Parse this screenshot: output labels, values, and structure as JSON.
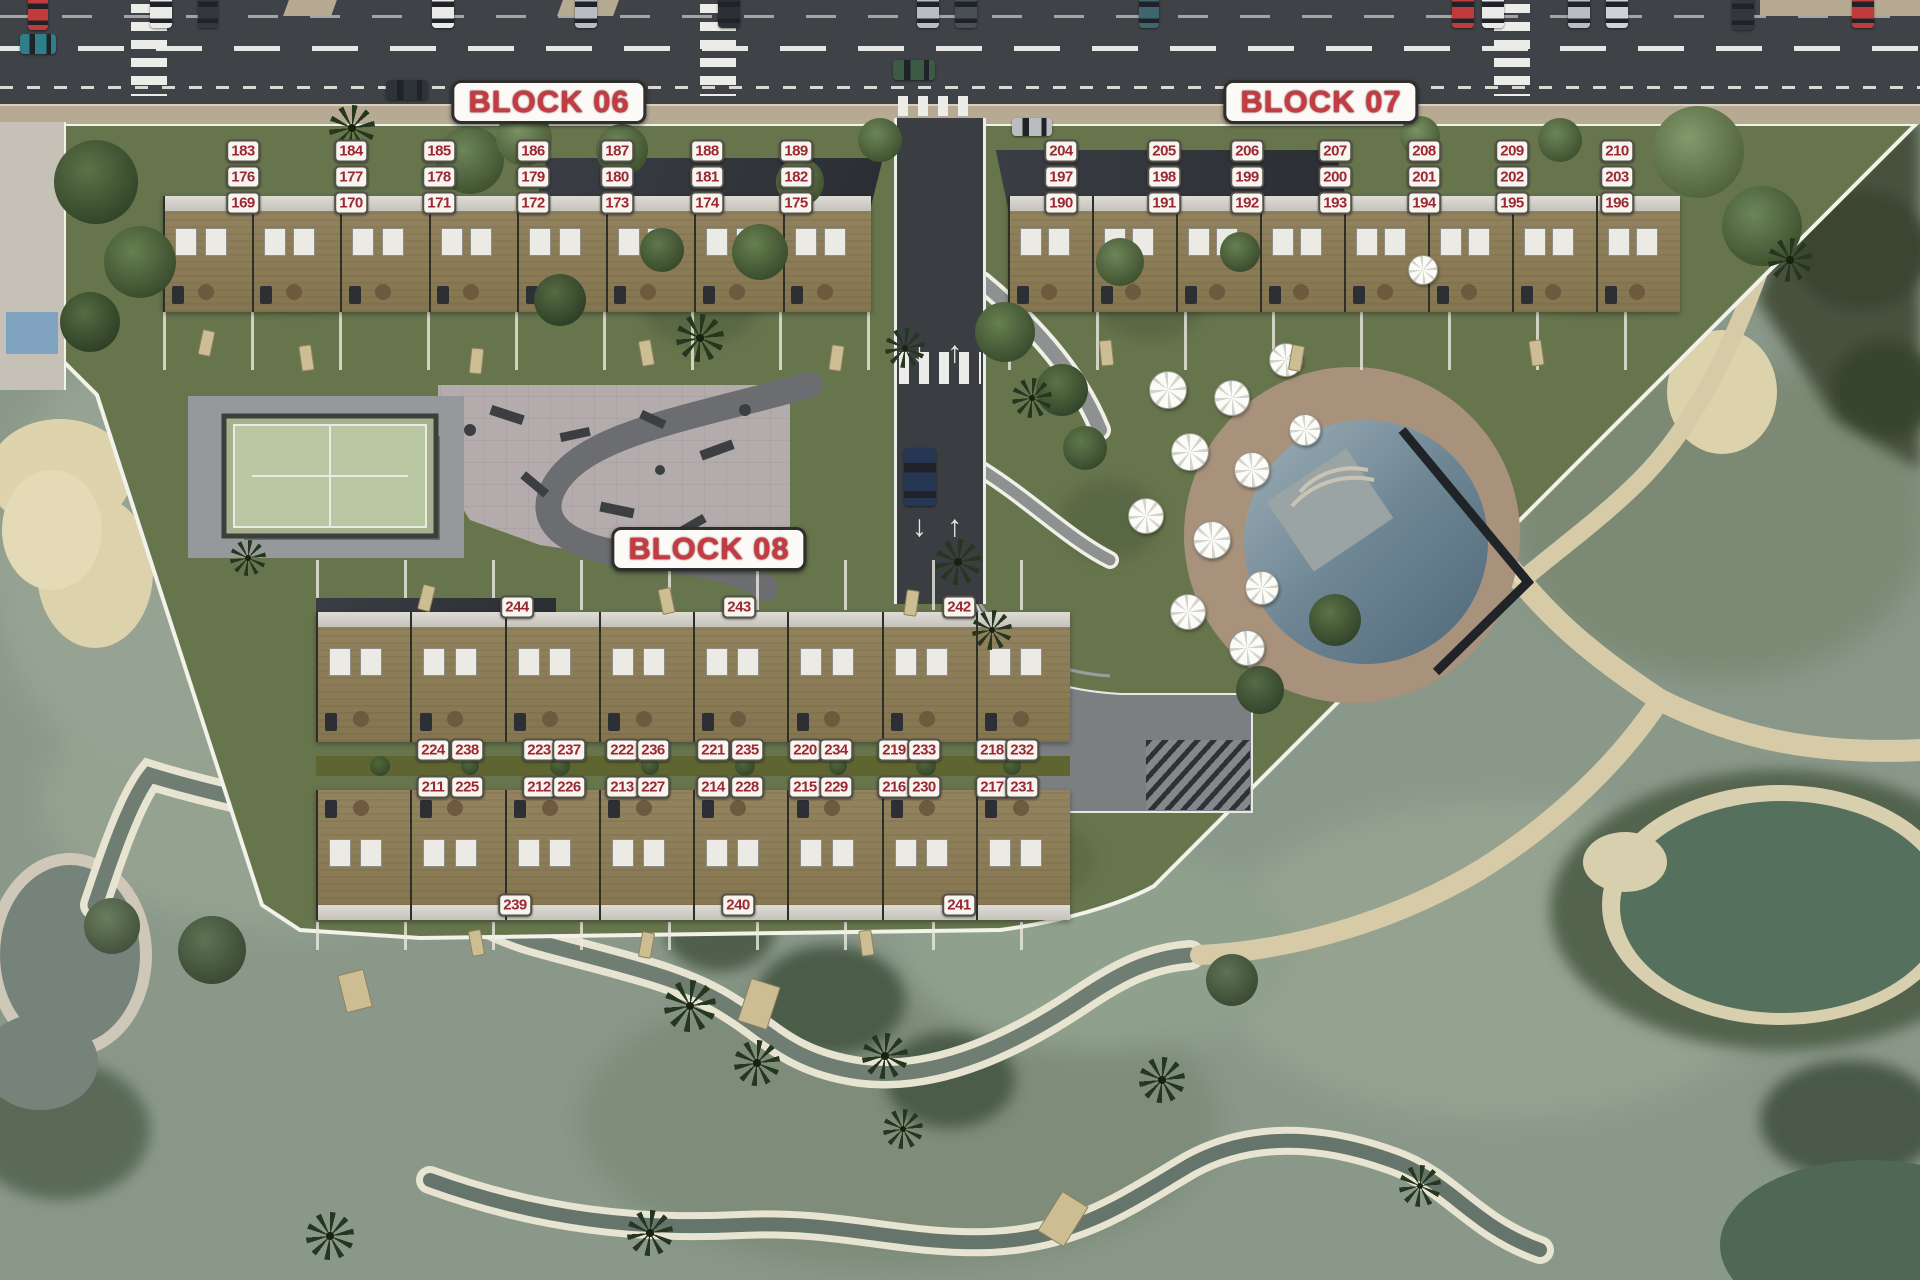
{
  "colors": {
    "label_bg": "#f7f5ef",
    "label_text": "#9b2733",
    "label_border": "#55504a",
    "title_text": "#c63a42",
    "title_outline": "#701a20",
    "title_bg": "#fbfaf6",
    "road_asphalt": "#3f4247",
    "sidewalk": "#b7aa93",
    "development_green": "#67754d",
    "golf_green": "#8a988a",
    "sand": "#dcd2ab",
    "path_tan": "#d6cba6",
    "plaza_paving": "#b4abac",
    "padel_court": "#b9c8a2",
    "pool_water": "#7c93a0",
    "pond_water": "#55705d",
    "pool_deck": "#a8927c",
    "building_deck": "#8c7e5e",
    "roof_dark": "#34383d",
    "stream_water": "#6f7d72"
  },
  "blocks": [
    {
      "title": "BLOCK 06",
      "title_x": 549,
      "title_y": 102,
      "units": [
        {
          "n": "183",
          "x": 243,
          "y": 151
        },
        {
          "n": "184",
          "x": 351,
          "y": 151
        },
        {
          "n": "185",
          "x": 439,
          "y": 151
        },
        {
          "n": "186",
          "x": 533,
          "y": 151
        },
        {
          "n": "187",
          "x": 617,
          "y": 151
        },
        {
          "n": "188",
          "x": 707,
          "y": 151
        },
        {
          "n": "189",
          "x": 796,
          "y": 151
        },
        {
          "n": "176",
          "x": 243,
          "y": 177
        },
        {
          "n": "177",
          "x": 351,
          "y": 177
        },
        {
          "n": "178",
          "x": 439,
          "y": 177
        },
        {
          "n": "179",
          "x": 533,
          "y": 177
        },
        {
          "n": "180",
          "x": 617,
          "y": 177
        },
        {
          "n": "181",
          "x": 707,
          "y": 177
        },
        {
          "n": "182",
          "x": 796,
          "y": 177
        },
        {
          "n": "169",
          "x": 243,
          "y": 203
        },
        {
          "n": "170",
          "x": 351,
          "y": 203
        },
        {
          "n": "171",
          "x": 439,
          "y": 203
        },
        {
          "n": "172",
          "x": 533,
          "y": 203
        },
        {
          "n": "173",
          "x": 617,
          "y": 203
        },
        {
          "n": "174",
          "x": 707,
          "y": 203
        },
        {
          "n": "175",
          "x": 796,
          "y": 203
        }
      ]
    },
    {
      "title": "BLOCK 07",
      "title_x": 1321,
      "title_y": 102,
      "units": [
        {
          "n": "204",
          "x": 1061,
          "y": 151
        },
        {
          "n": "205",
          "x": 1164,
          "y": 151
        },
        {
          "n": "206",
          "x": 1247,
          "y": 151
        },
        {
          "n": "207",
          "x": 1335,
          "y": 151
        },
        {
          "n": "208",
          "x": 1424,
          "y": 151
        },
        {
          "n": "209",
          "x": 1512,
          "y": 151
        },
        {
          "n": "210",
          "x": 1617,
          "y": 151
        },
        {
          "n": "197",
          "x": 1061,
          "y": 177
        },
        {
          "n": "198",
          "x": 1164,
          "y": 177
        },
        {
          "n": "199",
          "x": 1247,
          "y": 177
        },
        {
          "n": "200",
          "x": 1335,
          "y": 177
        },
        {
          "n": "201",
          "x": 1424,
          "y": 177
        },
        {
          "n": "202",
          "x": 1512,
          "y": 177
        },
        {
          "n": "203",
          "x": 1617,
          "y": 177
        },
        {
          "n": "190",
          "x": 1061,
          "y": 203
        },
        {
          "n": "191",
          "x": 1164,
          "y": 203
        },
        {
          "n": "192",
          "x": 1247,
          "y": 203
        },
        {
          "n": "193",
          "x": 1335,
          "y": 203
        },
        {
          "n": "194",
          "x": 1424,
          "y": 203
        },
        {
          "n": "195",
          "x": 1512,
          "y": 203
        },
        {
          "n": "196",
          "x": 1617,
          "y": 203
        }
      ]
    },
    {
      "title": "BLOCK 08",
      "title_x": 709,
      "title_y": 549,
      "units": [
        {
          "n": "244",
          "x": 517,
          "y": 607
        },
        {
          "n": "243",
          "x": 739,
          "y": 607
        },
        {
          "n": "242",
          "x": 959,
          "y": 607
        },
        {
          "n": "224",
          "x": 433,
          "y": 750
        },
        {
          "n": "238",
          "x": 467,
          "y": 750
        },
        {
          "n": "223",
          "x": 539,
          "y": 750
        },
        {
          "n": "237",
          "x": 569,
          "y": 750
        },
        {
          "n": "222",
          "x": 622,
          "y": 750
        },
        {
          "n": "236",
          "x": 653,
          "y": 750
        },
        {
          "n": "221",
          "x": 713,
          "y": 750
        },
        {
          "n": "235",
          "x": 747,
          "y": 750
        },
        {
          "n": "220",
          "x": 805,
          "y": 750
        },
        {
          "n": "234",
          "x": 836,
          "y": 750
        },
        {
          "n": "219",
          "x": 894,
          "y": 750
        },
        {
          "n": "233",
          "x": 924,
          "y": 750
        },
        {
          "n": "218",
          "x": 992,
          "y": 750
        },
        {
          "n": "232",
          "x": 1022,
          "y": 750
        },
        {
          "n": "211",
          "x": 433,
          "y": 787
        },
        {
          "n": "225",
          "x": 467,
          "y": 787
        },
        {
          "n": "212",
          "x": 539,
          "y": 787
        },
        {
          "n": "226",
          "x": 569,
          "y": 787
        },
        {
          "n": "213",
          "x": 622,
          "y": 787
        },
        {
          "n": "227",
          "x": 653,
          "y": 787
        },
        {
          "n": "214",
          "x": 713,
          "y": 787
        },
        {
          "n": "228",
          "x": 747,
          "y": 787
        },
        {
          "n": "215",
          "x": 805,
          "y": 787
        },
        {
          "n": "229",
          "x": 836,
          "y": 787
        },
        {
          "n": "216",
          "x": 894,
          "y": 787
        },
        {
          "n": "230",
          "x": 924,
          "y": 787
        },
        {
          "n": "217",
          "x": 992,
          "y": 787
        },
        {
          "n": "231",
          "x": 1022,
          "y": 787
        },
        {
          "n": "239",
          "x": 515,
          "y": 905
        },
        {
          "n": "240",
          "x": 738,
          "y": 905
        },
        {
          "n": "241",
          "x": 959,
          "y": 905
        }
      ]
    }
  ],
  "site": {
    "road_arrows": "↓ ↑",
    "buildings": [
      {
        "x": 163,
        "y": 196,
        "w": 708,
        "h": 116,
        "units": 8,
        "face": "down"
      },
      {
        "x": 1008,
        "y": 196,
        "w": 672,
        "h": 116,
        "units": 8,
        "face": "down"
      },
      {
        "x": 316,
        "y": 612,
        "w": 754,
        "h": 130,
        "units": 8,
        "face": "down"
      },
      {
        "x": 316,
        "y": 790,
        "w": 754,
        "h": 130,
        "units": 8,
        "face": "up"
      }
    ],
    "cars": [
      {
        "x": 20,
        "y": 34,
        "w": 36,
        "h": 20,
        "color": "#2f7f8a"
      },
      {
        "x": 28,
        "y": -6,
        "w": 20,
        "h": 36,
        "color": "#c23b3b"
      },
      {
        "x": 150,
        "y": -8,
        "w": 22,
        "h": 36,
        "color": "#e9e9e7"
      },
      {
        "x": 198,
        "y": -8,
        "w": 20,
        "h": 36,
        "color": "#34383d"
      },
      {
        "x": 432,
        "y": -8,
        "w": 22,
        "h": 36,
        "color": "#e9e9e7"
      },
      {
        "x": 575,
        "y": -8,
        "w": 22,
        "h": 36,
        "color": "#b9bdc1"
      },
      {
        "x": 718,
        "y": -8,
        "w": 22,
        "h": 36,
        "color": "#2c3034"
      },
      {
        "x": 893,
        "y": 60,
        "w": 42,
        "h": 20,
        "color": "#3d5a46"
      },
      {
        "x": 917,
        "y": -8,
        "w": 22,
        "h": 36,
        "color": "#b9bdc1"
      },
      {
        "x": 955,
        "y": -8,
        "w": 22,
        "h": 36,
        "color": "#4a4f55"
      },
      {
        "x": 1139,
        "y": -8,
        "w": 20,
        "h": 36,
        "color": "#3e6670"
      },
      {
        "x": 1452,
        "y": -8,
        "w": 22,
        "h": 36,
        "color": "#c23b3b"
      },
      {
        "x": 1482,
        "y": -8,
        "w": 22,
        "h": 36,
        "color": "#e9e9e7"
      },
      {
        "x": 1568,
        "y": -8,
        "w": 22,
        "h": 36,
        "color": "#b9bdc1"
      },
      {
        "x": 1606,
        "y": -8,
        "w": 22,
        "h": 36,
        "color": "#d0d3d6"
      },
      {
        "x": 1732,
        "y": -6,
        "w": 22,
        "h": 36,
        "color": "#34383d"
      },
      {
        "x": 1852,
        "y": -8,
        "w": 22,
        "h": 36,
        "color": "#c23b3b"
      },
      {
        "x": 386,
        "y": 80,
        "w": 42,
        "h": 20,
        "color": "#2e3338"
      },
      {
        "x": 1012,
        "y": 118,
        "w": 40,
        "h": 18,
        "color": "#b9bdc1"
      },
      {
        "x": 904,
        "y": 448,
        "w": 32,
        "h": 58,
        "color": "#253752"
      }
    ],
    "umbrellas": [
      {
        "x": 1168,
        "y": 390,
        "r": 18
      },
      {
        "x": 1232,
        "y": 398,
        "r": 17
      },
      {
        "x": 1286,
        "y": 360,
        "r": 16
      },
      {
        "x": 1190,
        "y": 452,
        "r": 18
      },
      {
        "x": 1252,
        "y": 470,
        "r": 17
      },
      {
        "x": 1146,
        "y": 516,
        "r": 17
      },
      {
        "x": 1212,
        "y": 540,
        "r": 18
      },
      {
        "x": 1262,
        "y": 588,
        "r": 16
      },
      {
        "x": 1188,
        "y": 612,
        "r": 17
      },
      {
        "x": 1247,
        "y": 648,
        "r": 17
      },
      {
        "x": 1305,
        "y": 430,
        "r": 15
      },
      {
        "x": 1423,
        "y": 270,
        "r": 14
      }
    ],
    "palms": [
      {
        "x": 352,
        "y": 128,
        "s": 46
      },
      {
        "x": 700,
        "y": 338,
        "s": 48
      },
      {
        "x": 905,
        "y": 348,
        "s": 40
      },
      {
        "x": 1032,
        "y": 398,
        "s": 40
      },
      {
        "x": 958,
        "y": 562,
        "s": 46
      },
      {
        "x": 992,
        "y": 630,
        "s": 40
      },
      {
        "x": 248,
        "y": 558,
        "s": 36
      },
      {
        "x": 690,
        "y": 1006,
        "s": 52
      },
      {
        "x": 757,
        "y": 1063,
        "s": 46
      },
      {
        "x": 885,
        "y": 1056,
        "s": 46
      },
      {
        "x": 1162,
        "y": 1080,
        "s": 46
      },
      {
        "x": 330,
        "y": 1236,
        "s": 48
      },
      {
        "x": 650,
        "y": 1233,
        "s": 46
      },
      {
        "x": 903,
        "y": 1129,
        "s": 40
      },
      {
        "x": 1420,
        "y": 1186,
        "s": 42
      },
      {
        "x": 1790,
        "y": 260,
        "s": 44
      }
    ],
    "trees": [
      {
        "x": 96,
        "y": 182,
        "r": 42,
        "c1": "#5c7247",
        "c2": "#33452a"
      },
      {
        "x": 140,
        "y": 262,
        "r": 36,
        "c1": "#67804f",
        "c2": "#3a4c2e"
      },
      {
        "x": 90,
        "y": 322,
        "r": 30,
        "c1": "#546b42",
        "c2": "#2f4026"
      },
      {
        "x": 470,
        "y": 160,
        "r": 34,
        "c1": "#6d855a",
        "c2": "#40522f"
      },
      {
        "x": 524,
        "y": 138,
        "r": 28,
        "c1": "#7b9265",
        "c2": "#4a5c36"
      },
      {
        "x": 622,
        "y": 150,
        "r": 26,
        "c1": "#6d855a",
        "c2": "#40522f"
      },
      {
        "x": 662,
        "y": 250,
        "r": 22,
        "c1": "#60784c",
        "c2": "#384a2c"
      },
      {
        "x": 560,
        "y": 300,
        "r": 26,
        "c1": "#546b42",
        "c2": "#2f4026"
      },
      {
        "x": 760,
        "y": 252,
        "r": 28,
        "c1": "#67804f",
        "c2": "#3a4c2e"
      },
      {
        "x": 800,
        "y": 182,
        "r": 24,
        "c1": "#6d855a",
        "c2": "#40522f"
      },
      {
        "x": 1005,
        "y": 332,
        "r": 30,
        "c1": "#67804f",
        "c2": "#3a4c2e"
      },
      {
        "x": 1062,
        "y": 390,
        "r": 26,
        "c1": "#5c7247",
        "c2": "#33452a"
      },
      {
        "x": 1120,
        "y": 262,
        "r": 24,
        "c1": "#6d855a",
        "c2": "#40522f"
      },
      {
        "x": 1240,
        "y": 252,
        "r": 20,
        "c1": "#67804f",
        "c2": "#3a4c2e"
      },
      {
        "x": 880,
        "y": 140,
        "r": 22,
        "c1": "#6d855a",
        "c2": "#40522f"
      },
      {
        "x": 1420,
        "y": 136,
        "r": 20,
        "c1": "#7b9265",
        "c2": "#4a5c36"
      },
      {
        "x": 1560,
        "y": 140,
        "r": 22,
        "c1": "#6d855a",
        "c2": "#40522f"
      },
      {
        "x": 1698,
        "y": 152,
        "r": 46,
        "c1": "#84996c",
        "c2": "#51643c"
      },
      {
        "x": 1762,
        "y": 226,
        "r": 40,
        "c1": "#6d855a",
        "c2": "#40522f"
      },
      {
        "x": 1335,
        "y": 620,
        "r": 26,
        "c1": "#5c7247",
        "c2": "#33452a"
      },
      {
        "x": 1085,
        "y": 448,
        "r": 22,
        "c1": "#60784c",
        "c2": "#384a2c"
      },
      {
        "x": 212,
        "y": 950,
        "r": 34,
        "c1": "#5f7354",
        "c2": "#3b4a34"
      },
      {
        "x": 112,
        "y": 926,
        "r": 28,
        "c1": "#6a7d5e",
        "c2": "#44533c"
      },
      {
        "x": 1232,
        "y": 980,
        "r": 26,
        "c1": "#5f7354",
        "c2": "#3b4a34"
      },
      {
        "x": 1260,
        "y": 690,
        "r": 24,
        "c1": "#566b48",
        "c2": "#33452a"
      },
      {
        "x": 620,
        "y": 830,
        "r": 0,
        "c1": "#566b48",
        "c2": "#33452a"
      }
    ],
    "loungers": [
      {
        "x": 200,
        "y": 330,
        "rot": 12
      },
      {
        "x": 300,
        "y": 345,
        "rot": -8
      },
      {
        "x": 470,
        "y": 348,
        "rot": 6
      },
      {
        "x": 640,
        "y": 340,
        "rot": -10
      },
      {
        "x": 830,
        "y": 345,
        "rot": 8
      },
      {
        "x": 1100,
        "y": 340,
        "rot": -6
      },
      {
        "x": 1290,
        "y": 345,
        "rot": 10
      },
      {
        "x": 1530,
        "y": 340,
        "rot": -8
      },
      {
        "x": 420,
        "y": 585,
        "rot": 14
      },
      {
        "x": 660,
        "y": 588,
        "rot": -12
      },
      {
        "x": 905,
        "y": 590,
        "rot": 8
      },
      {
        "x": 470,
        "y": 930,
        "rot": -10
      },
      {
        "x": 640,
        "y": 932,
        "rot": 10
      },
      {
        "x": 860,
        "y": 930,
        "rot": -8
      }
    ],
    "bushes": [
      {
        "x": 380,
        "y": 766,
        "r": 10
      },
      {
        "x": 470,
        "y": 766,
        "r": 9
      },
      {
        "x": 560,
        "y": 766,
        "r": 10
      },
      {
        "x": 650,
        "y": 766,
        "r": 9
      },
      {
        "x": 745,
        "y": 766,
        "r": 10
      },
      {
        "x": 838,
        "y": 766,
        "r": 9
      },
      {
        "x": 926,
        "y": 766,
        "r": 10
      },
      {
        "x": 1012,
        "y": 766,
        "r": 9
      }
    ]
  }
}
